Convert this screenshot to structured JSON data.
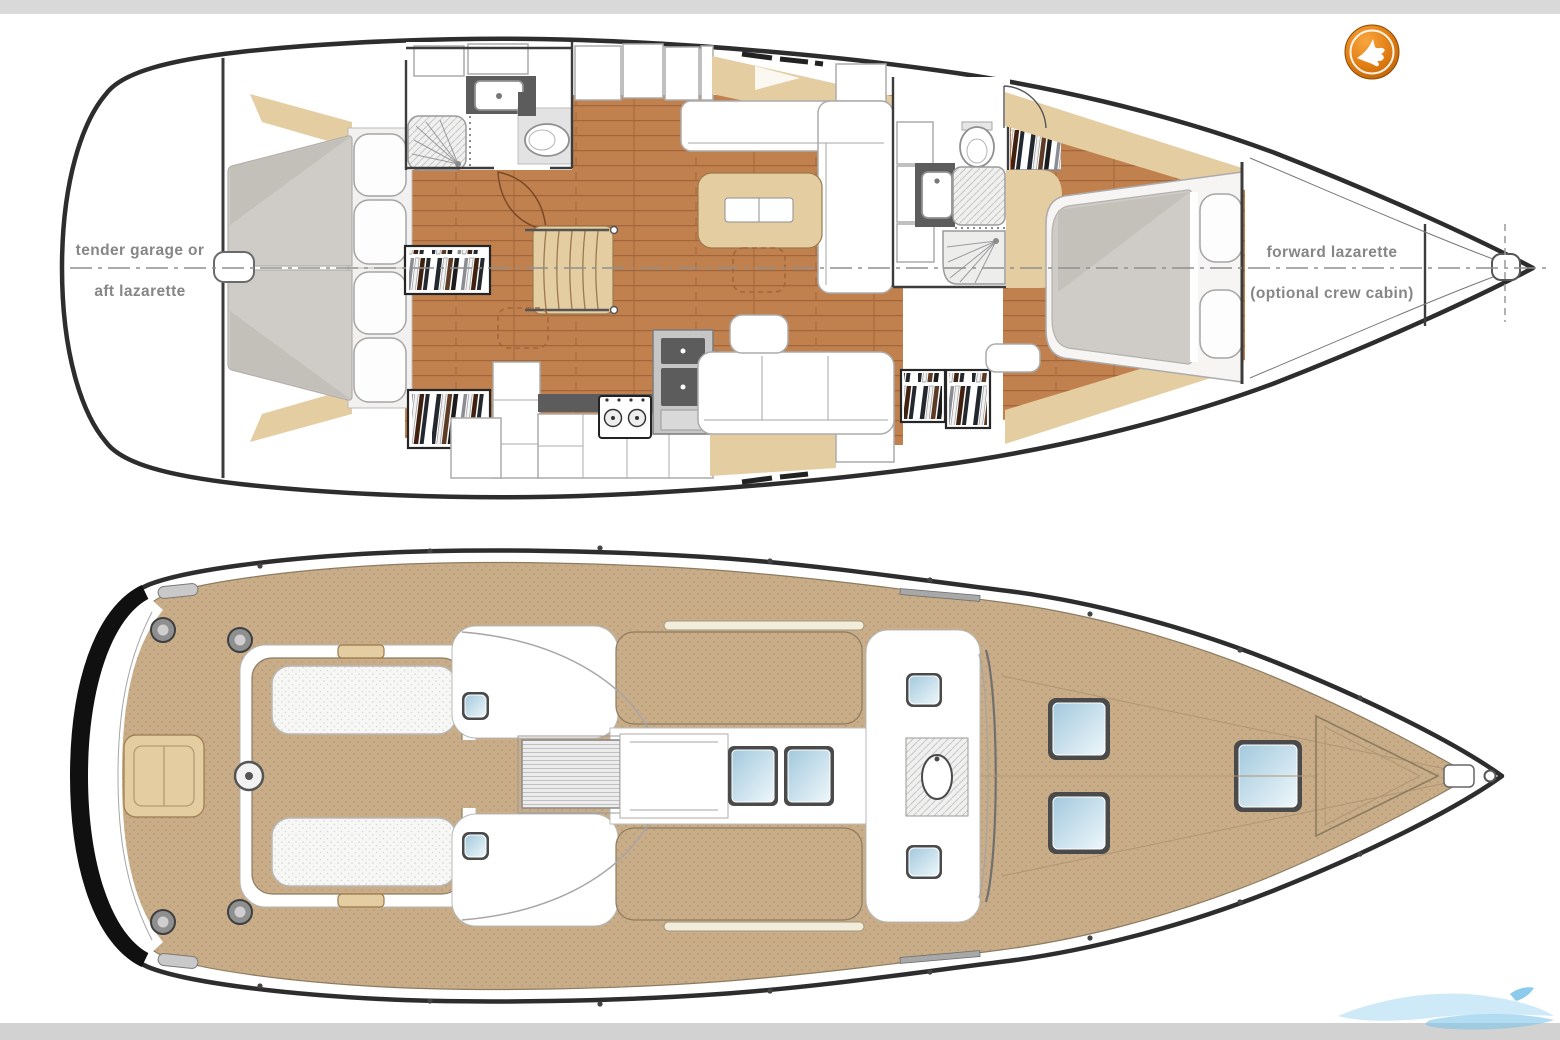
{
  "page": {
    "background": "#ffffff",
    "width": 1560,
    "height": 1040
  },
  "bars": {
    "top_color": "#d9d9d9",
    "bottom_color": "#d2d2d2"
  },
  "colors": {
    "hull": "#2d2d2d",
    "wall": "#3c3c3c",
    "label": "#868686",
    "wood": "#c1814f",
    "plank": "#a2663a",
    "tan": "#e5cda2",
    "tanStroke": "#9b7a4d",
    "teak": "#c9ad88",
    "teakDot": "#b49772",
    "mattress": "#cfccc7",
    "mattressShade": "#c1bdb7",
    "pillow": "#fdfdfd",
    "fixtureStroke": "#909090",
    "counter": "#5c5c5c",
    "hatchBlue1": "#a3c9dd",
    "hatchBlue2": "#eef7fb",
    "logoHi": "#f9a63e",
    "logoMid": "#e07d12",
    "logoOuter": "#b55f07",
    "water": "#a6d8f3"
  },
  "interior_plan": {
    "name": "interior accommodation plan",
    "labels": {
      "aft_l1": "tender garage or",
      "aft_l2": "aft lazarette",
      "fwd_l1": "forward lazarette",
      "fwd_l2": "(optional crew cabin)"
    }
  },
  "deck_plan": {
    "name": "deck plan"
  },
  "branding": {
    "logo_icon": "bird-badge-icon",
    "watermark_icon": "wave-swoosh-icon"
  }
}
